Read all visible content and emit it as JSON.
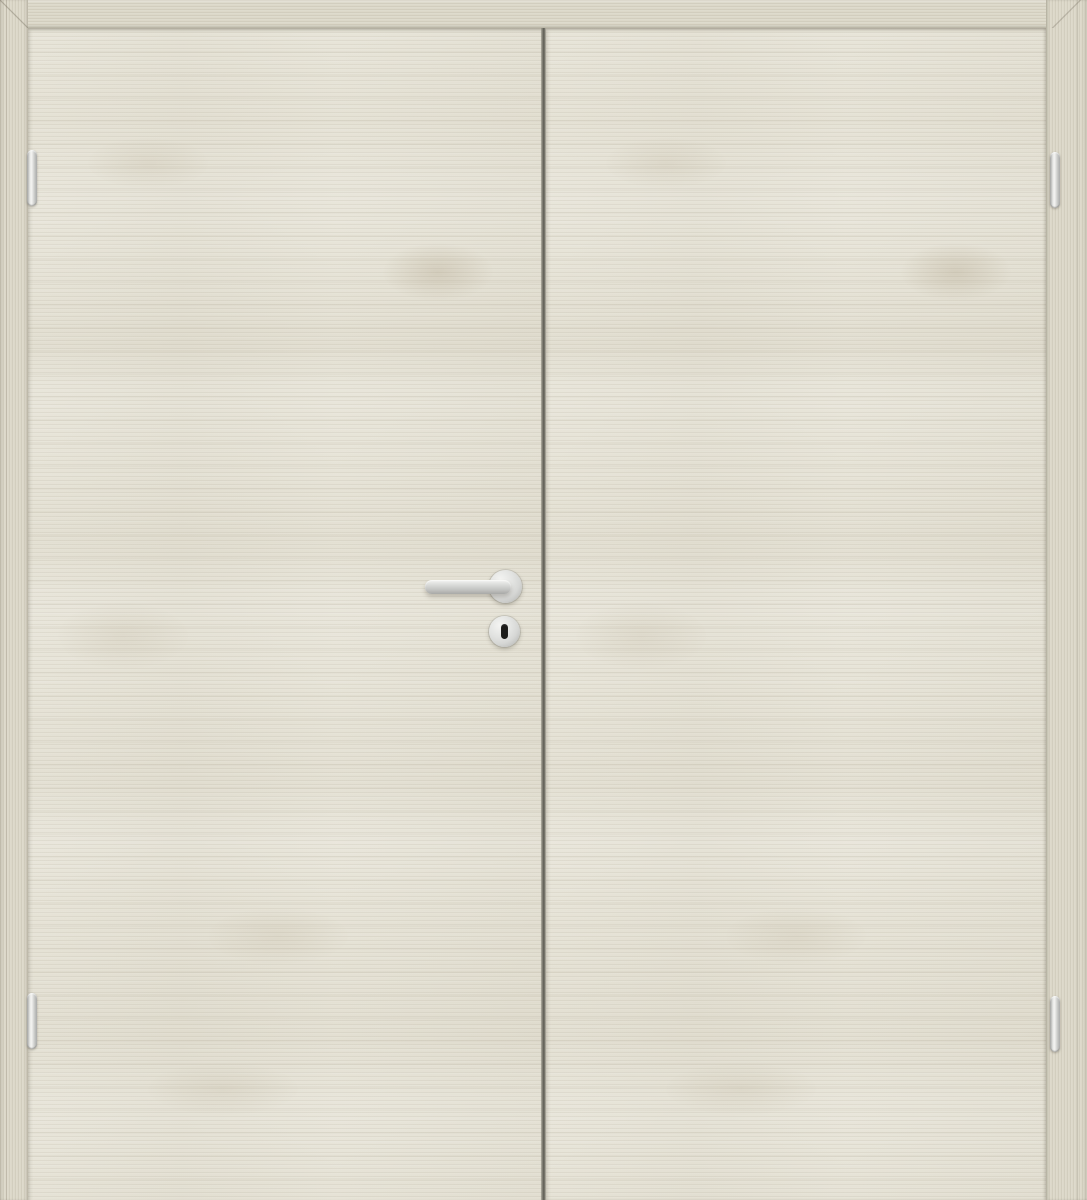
{
  "scene": {
    "subject": "closed interior double door, front view",
    "finish": "light white-pine wood laminate, horizontal grain",
    "components": [
      "door-frame",
      "left-door-leaf",
      "right-door-leaf",
      "lever-handle",
      "keyhole-escutcheon",
      "hinges"
    ]
  },
  "hardware": {
    "handle_type": "stainless-steel lever handle on round rosette",
    "keyhole_type": "vertical keyhole slot in round escutcheon",
    "hinge_count": 4,
    "hinge_layout": "two per side, at top and bottom of frame junction"
  },
  "theme": {
    "door_face": "#e7e4d8",
    "frame_face": "#dcd8c9",
    "center_gap_dark": "#5d5c53",
    "center_gap_mid": "#6e6d63",
    "metal_light": "#f4f4f2",
    "metal_mid": "#d6d7d5",
    "metal_dark": "#a8a9a7",
    "keyhole": "#1c1c1a"
  }
}
